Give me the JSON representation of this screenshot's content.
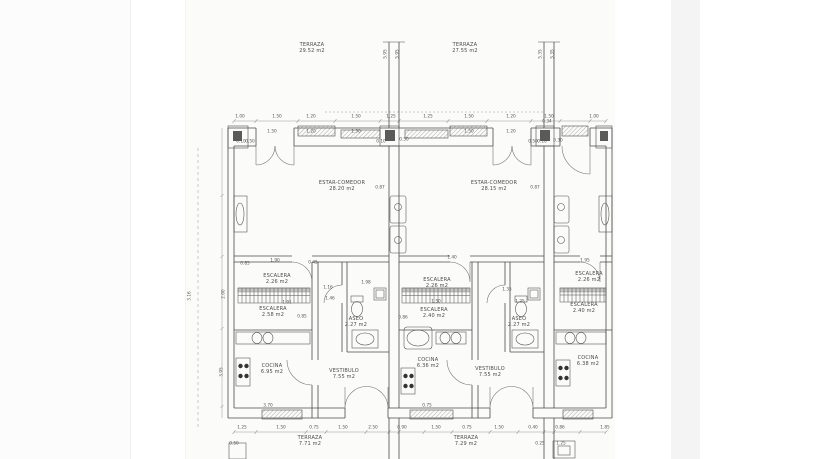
{
  "document": {
    "type": "architectural-floor-plan",
    "language": "es",
    "paper_color": "#fbfbfa",
    "line_color": "#4c4c4c",
    "text_color": "#4a4a4a"
  },
  "plan": {
    "room_labels": [
      {
        "id": "label-terraza-top-left",
        "name": "TERRAZA",
        "area": "29.52 m2",
        "x": 312,
        "y": 48
      },
      {
        "id": "label-terraza-top-right",
        "name": "TERRAZA",
        "area": "27.55 m2",
        "x": 465,
        "y": 48
      },
      {
        "id": "label-estar-comedor-left",
        "name": "ESTAR-COMEDOR",
        "area": "28.20 m2",
        "x": 342,
        "y": 186
      },
      {
        "id": "label-estar-comedor-right",
        "name": "ESTAR-COMEDOR",
        "area": "28.15 m2",
        "x": 494,
        "y": 186
      },
      {
        "id": "label-escalera-1-upper",
        "name": "ESCALERA",
        "area": "2.26 m2",
        "x": 277,
        "y": 279
      },
      {
        "id": "label-escalera-1-lower",
        "name": "ESCALERA",
        "area": "2.58 m2",
        "x": 273,
        "y": 312
      },
      {
        "id": "label-escalera-2-upper",
        "name": "ESCALERA",
        "area": "2.26 m2",
        "x": 437,
        "y": 283
      },
      {
        "id": "label-escalera-2-lower",
        "name": "ESCALERA",
        "area": "2.40 m2",
        "x": 434,
        "y": 313
      },
      {
        "id": "label-escalera-3-upper",
        "name": "ESCALERA",
        "area": "2.26 m2",
        "x": 589,
        "y": 277
      },
      {
        "id": "label-escalera-3-lower",
        "name": "ESCALERA",
        "area": "2.40 m2",
        "x": 584,
        "y": 308
      },
      {
        "id": "label-aseo-left",
        "name": "ASEO",
        "area": "2.27 m2",
        "x": 356,
        "y": 322
      },
      {
        "id": "label-aseo-right",
        "name": "ASEO",
        "area": "2.27 m2",
        "x": 519,
        "y": 322
      },
      {
        "id": "label-cocina-1",
        "name": "COCINA",
        "area": "6.95 m2",
        "x": 272,
        "y": 369
      },
      {
        "id": "label-vestibulo-1",
        "name": "VESTIBULO",
        "area": "7.55 m2",
        "x": 344,
        "y": 374
      },
      {
        "id": "label-cocina-2",
        "name": "COCINA",
        "area": "6.36 m2",
        "x": 428,
        "y": 363
      },
      {
        "id": "label-vestibulo-2",
        "name": "VESTIBULO",
        "area": "7.55 m2",
        "x": 490,
        "y": 372
      },
      {
        "id": "label-cocina-3",
        "name": "COCINA",
        "area": "6.38 m2",
        "x": 588,
        "y": 361
      },
      {
        "id": "label-terraza-bottom-left",
        "name": "TERRAZA",
        "area": "7.71 m2",
        "x": 310,
        "y": 441
      },
      {
        "id": "label-terraza-bottom-right",
        "name": "TERRAZA",
        "area": "7.29 m2",
        "x": 466,
        "y": 441
      }
    ],
    "dims": [
      {
        "t": "1.00",
        "x": 240,
        "y": 117
      },
      {
        "t": "1.50",
        "x": 277,
        "y": 117
      },
      {
        "t": "1.20",
        "x": 311,
        "y": 117
      },
      {
        "t": "1.50",
        "x": 356,
        "y": 117
      },
      {
        "t": "1.25",
        "x": 391,
        "y": 117
      },
      {
        "t": "1.25",
        "x": 428,
        "y": 117
      },
      {
        "t": "1.50",
        "x": 469,
        "y": 117
      },
      {
        "t": "1.20",
        "x": 511,
        "y": 117
      },
      {
        "t": "1.50",
        "x": 549,
        "y": 117
      },
      {
        "t": "1.00",
        "x": 594,
        "y": 117
      },
      {
        "t": "1.50",
        "x": 272,
        "y": 132
      },
      {
        "t": "1.20",
        "x": 311,
        "y": 132
      },
      {
        "t": "1.50",
        "x": 356,
        "y": 132
      },
      {
        "t": "1.50",
        "x": 469,
        "y": 132
      },
      {
        "t": "1.20",
        "x": 511,
        "y": 132
      },
      {
        "t": "5.95",
        "x": 386,
        "y": 54,
        "r": 1
      },
      {
        "t": "5.95",
        "x": 398,
        "y": 54,
        "r": 1
      },
      {
        "t": "5.35",
        "x": 541,
        "y": 54,
        "r": 1
      },
      {
        "t": "5.35",
        "x": 553,
        "y": 54,
        "r": 1
      },
      {
        "t": "3.16",
        "x": 190,
        "y": 296,
        "r": 1
      },
      {
        "t": "2.00",
        "x": 224,
        "y": 294,
        "r": 1
      },
      {
        "t": "3.95",
        "x": 222,
        "y": 372,
        "r": 1
      },
      {
        "t": "0.10",
        "x": 241,
        "y": 142
      },
      {
        "t": "0.50",
        "x": 250,
        "y": 142
      },
      {
        "t": "0.10",
        "x": 381,
        "y": 142
      },
      {
        "t": "0.50",
        "x": 404,
        "y": 140
      },
      {
        "t": "0.50",
        "x": 533,
        "y": 142
      },
      {
        "t": "0.10",
        "x": 542,
        "y": 142
      },
      {
        "t": "0.34",
        "x": 547,
        "y": 122
      },
      {
        "t": "0.30",
        "x": 558,
        "y": 141
      },
      {
        "t": "0.87",
        "x": 380,
        "y": 188
      },
      {
        "t": "0.87",
        "x": 535,
        "y": 188
      },
      {
        "t": "0.85",
        "x": 245,
        "y": 264
      },
      {
        "t": "1.90",
        "x": 275,
        "y": 261
      },
      {
        "t": "0.45",
        "x": 313,
        "y": 263
      },
      {
        "t": "1.16",
        "x": 328,
        "y": 288
      },
      {
        "t": "1.46",
        "x": 330,
        "y": 299
      },
      {
        "t": "1.91",
        "x": 287,
        "y": 303
      },
      {
        "t": "0.85",
        "x": 302,
        "y": 317
      },
      {
        "t": "1.98",
        "x": 366,
        "y": 283
      },
      {
        "t": "0.86",
        "x": 403,
        "y": 318
      },
      {
        "t": "1.50",
        "x": 436,
        "y": 302
      },
      {
        "t": "1.40",
        "x": 452,
        "y": 258
      },
      {
        "t": "1.95",
        "x": 585,
        "y": 261
      },
      {
        "t": "1.35",
        "x": 507,
        "y": 290
      },
      {
        "t": "1.25",
        "x": 520,
        "y": 302
      },
      {
        "t": "3.70",
        "x": 268,
        "y": 406
      },
      {
        "t": "0.75",
        "x": 427,
        "y": 406
      },
      {
        "t": "1.25",
        "x": 242,
        "y": 428
      },
      {
        "t": "1.50",
        "x": 281,
        "y": 428
      },
      {
        "t": "0.75",
        "x": 314,
        "y": 428
      },
      {
        "t": "1.50",
        "x": 343,
        "y": 428
      },
      {
        "t": "2.50",
        "x": 373,
        "y": 428
      },
      {
        "t": "0.90",
        "x": 402,
        "y": 428
      },
      {
        "t": "1.50",
        "x": 436,
        "y": 428
      },
      {
        "t": "0.75",
        "x": 467,
        "y": 428
      },
      {
        "t": "1.50",
        "x": 499,
        "y": 428
      },
      {
        "t": "0.40",
        "x": 533,
        "y": 428
      },
      {
        "t": "0.86",
        "x": 560,
        "y": 428
      },
      {
        "t": "1.85",
        "x": 605,
        "y": 428
      },
      {
        "t": "0.50",
        "x": 234,
        "y": 444
      },
      {
        "t": "0.25",
        "x": 540,
        "y": 444
      },
      {
        "t": "1.25",
        "x": 561,
        "y": 444
      }
    ]
  }
}
